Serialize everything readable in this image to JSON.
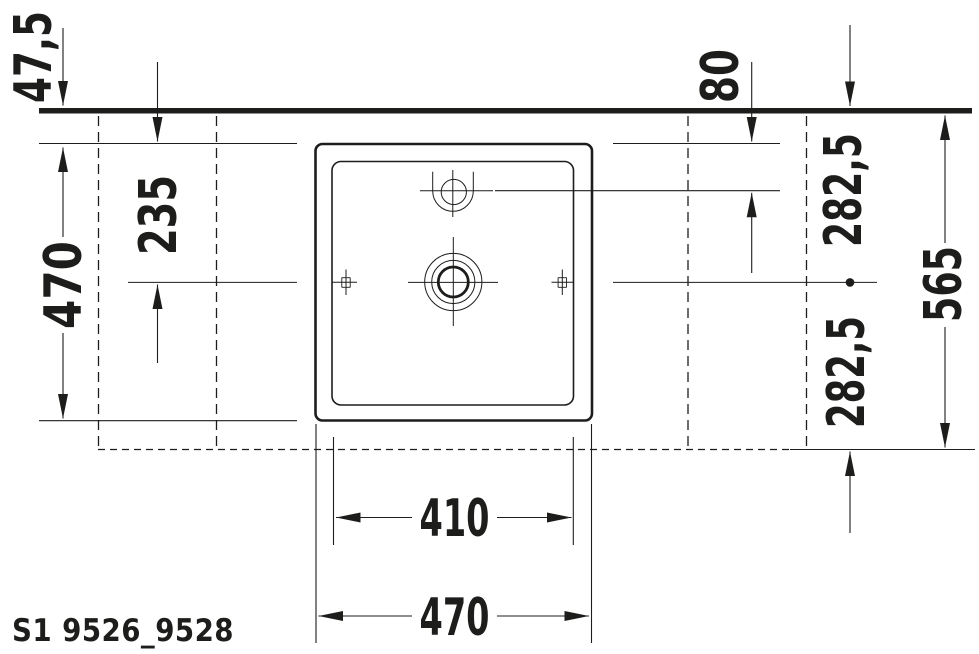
{
  "product": {
    "code": "S1 9526_9528"
  },
  "colors": {
    "ink": "#1d1d1b",
    "paper": "#ffffff"
  },
  "dims": {
    "wall_to_basin_back": "47,5",
    "basin_depth_side": "470",
    "drain_center_from_basin_back": "235",
    "tap_hole_from_basin_back": "80",
    "wall_to_drain_center": "282,5",
    "drain_center_to_console_front": "282,5",
    "wall_to_console_front_total": "565",
    "basin_inner_width": "410",
    "basin_outer_width": "470"
  }
}
